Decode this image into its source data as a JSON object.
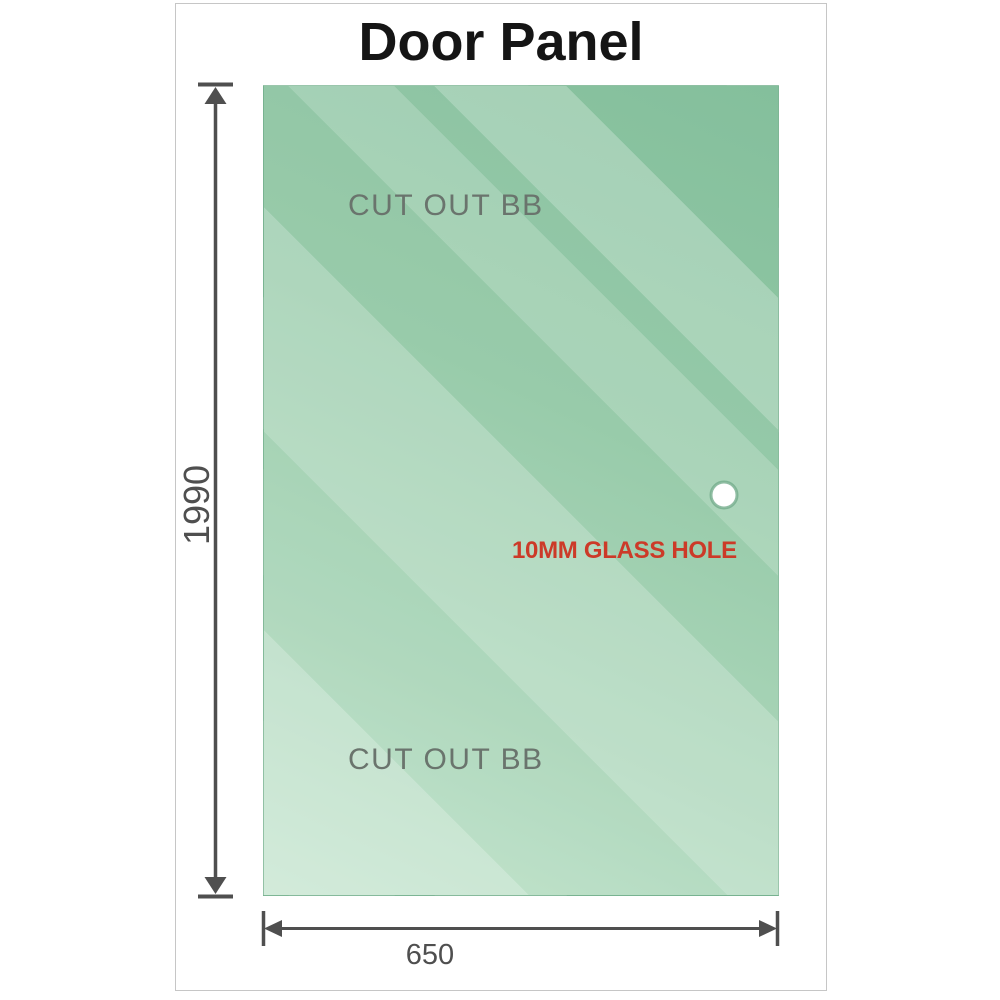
{
  "title": "Door Panel",
  "panel": {
    "description": "glass door panel diagram",
    "cutouts": [
      {
        "label": "CUT OUT BB",
        "position": "top-left-edge"
      },
      {
        "label": "CUT OUT BB",
        "position": "bottom-left-edge"
      }
    ],
    "hole": {
      "label": "10MM GLASS HOLE",
      "position": "right-middle"
    }
  },
  "dimensions": {
    "height": "1990",
    "width": "650"
  },
  "colors": {
    "glass_dark": "#84bf9c",
    "glass_light": "#c9e7d2",
    "dimension_lines": "#4f4f4f",
    "hole_label_red": "#cc3a28",
    "cutout_label_gray": "#6a746d",
    "title_black": "#151515",
    "card_border": "#c6c6c6"
  }
}
